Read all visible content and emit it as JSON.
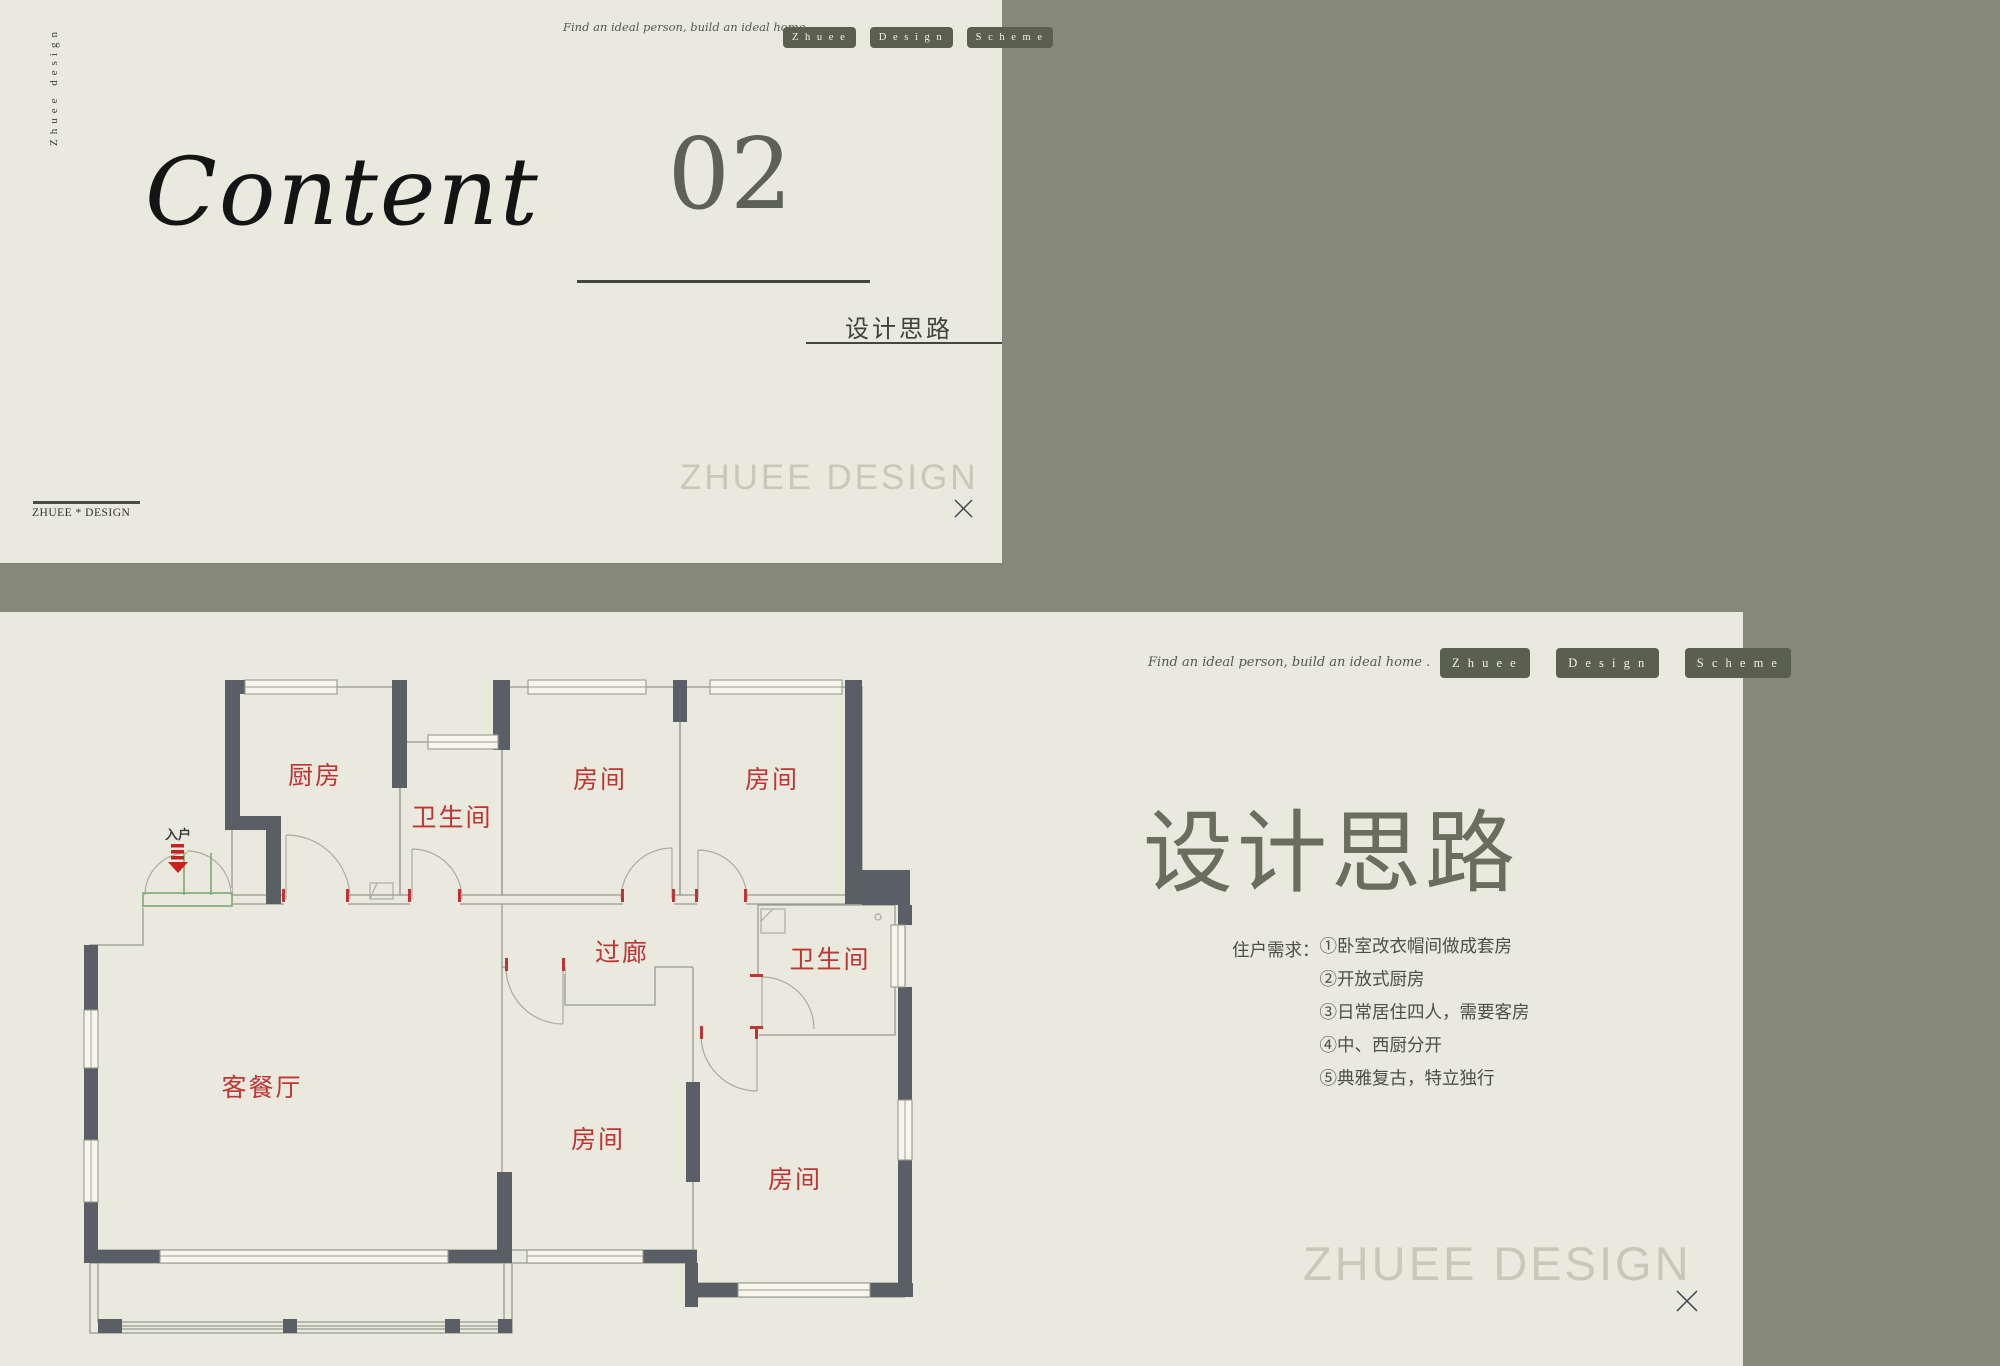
{
  "colors": {
    "page_bg": "#868979",
    "panel_bg": "#eae9dd",
    "button_bg": "#5b5f50",
    "room_label_red": "#bf3434",
    "wall_dark": "#5a5e65",
    "watermark_gray": "#c9c7b8"
  },
  "top_panel": {
    "vertical_brand": "Zhuee design",
    "tagline": "Find an ideal person, build an ideal home .",
    "nav_buttons": [
      "Z h u e e",
      "D e s i g n",
      "S c h e m e"
    ],
    "title": "Content",
    "chapter_number": "02",
    "chapter_label": "设计思路",
    "watermark": "ZHUEE DESIGN",
    "footer_brand": "ZHUEE * DESIGN"
  },
  "bottom_panel": {
    "tagline": "Find an ideal person, build an ideal home .",
    "nav_buttons": [
      "Z h u e e",
      "D e s i g n",
      "S c h e m e"
    ],
    "title": "设计思路",
    "requirements_label": "住户需求：",
    "requirements": [
      "①卧室改衣帽间做成套房",
      "②开放式厨房",
      "③日常居住四人，需要客房",
      "④中、西厨分开",
      "⑤典雅复古，特立独行"
    ],
    "watermark": "ZHUEE DESIGN"
  },
  "floor_plan": {
    "entrance_label": "入户",
    "labels": {
      "kitchen": "厨房",
      "bath_top": "卫生间",
      "room_top_1": "房间",
      "room_top_2": "房间",
      "corridor": "过廊",
      "bath_mid": "卫生间",
      "living_dining": "客餐厅",
      "room_bottom_mid": "房间",
      "room_bottom_right": "房间"
    }
  }
}
